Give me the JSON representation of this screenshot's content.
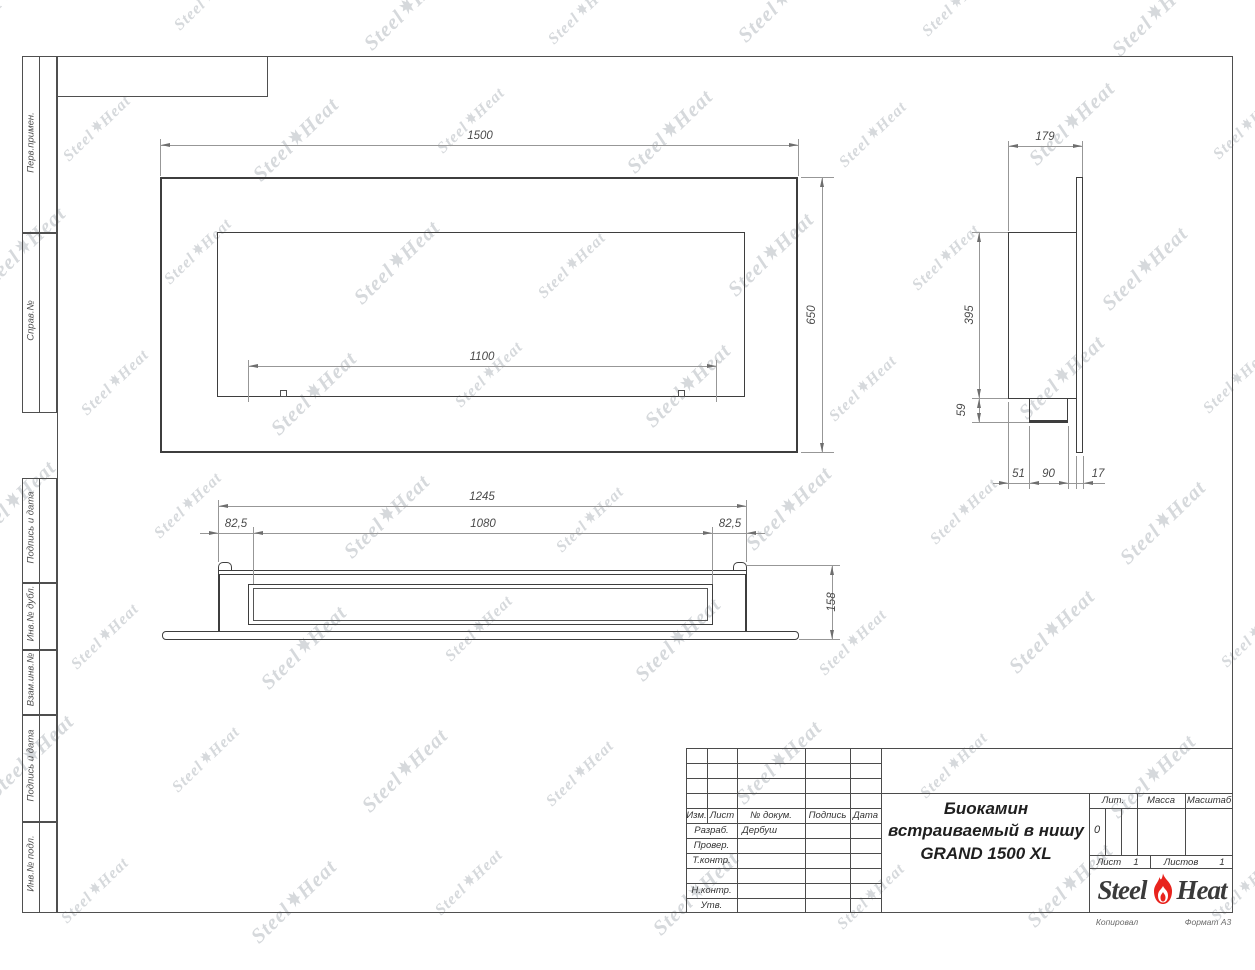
{
  "sheet": {
    "margin_labels": [
      "Перв.примен.",
      "Справ.№",
      "Подпись и дата",
      "Инв.№ дубл.",
      "Взам.инв.№",
      "Подпись и дата",
      "Инв.№ подл."
    ],
    "footer": {
      "copied": "Копировал",
      "format": "Формат А3"
    }
  },
  "drawing": {
    "front_view": {
      "width": "1500",
      "height": "650",
      "burner_width": "1100"
    },
    "side_view": {
      "depth": "179",
      "body_height": "395",
      "tray_height": "59",
      "offset_51": "51",
      "offset_90": "90",
      "offset_17": "17"
    },
    "bottom_view": {
      "body_width": "1245",
      "opening_width": "1080",
      "offset_left": "82,5",
      "offset_right": "82,5",
      "depth": "158"
    }
  },
  "title_block": {
    "revision_header": [
      "Изм.",
      "Лист",
      "№ докум.",
      "Подпись",
      "Дата"
    ],
    "staff_rows": [
      {
        "label": "Разраб.",
        "name": "Дербуш"
      },
      {
        "label": "Провер.",
        "name": ""
      },
      {
        "label": "Т.контр.",
        "name": ""
      },
      {
        "label": "Н.контр.",
        "name": ""
      },
      {
        "label": "Утв.",
        "name": ""
      }
    ],
    "product_name": [
      "Биокамин",
      "встраиваемый в нишу",
      "GRAND 1500 XL"
    ],
    "lit_label": "Лит.",
    "lit_value": "0",
    "mass_label": "Масса",
    "scale_label": "Масштаб",
    "sheet_label": "Лист",
    "sheet_value": "1",
    "sheets_label": "Листов",
    "sheets_value": "1"
  },
  "brand": {
    "steel": "Steel",
    "heat": "Heat",
    "flame_color": "#e8231d",
    "watermark_color": "#d6d9dc"
  }
}
